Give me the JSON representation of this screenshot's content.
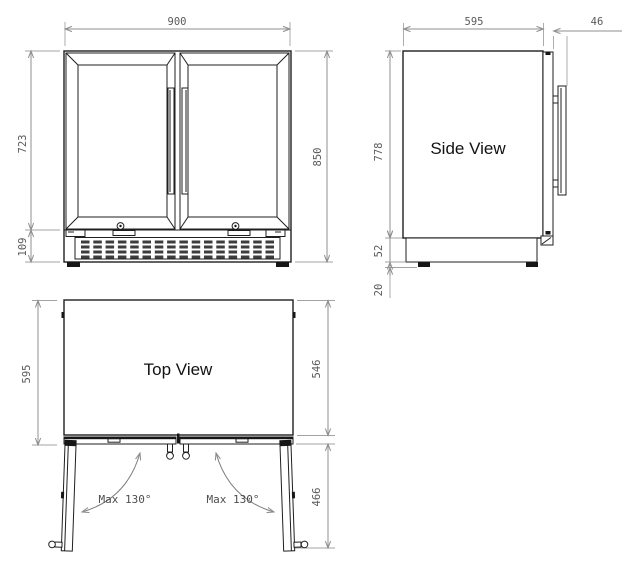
{
  "drawing": {
    "front_view": {
      "width_label": "900",
      "door_height_label": "723",
      "base_height_label": "109",
      "total_height_label": "850"
    },
    "side_view": {
      "title": "Side View",
      "depth_label": "595",
      "door_thickness_label": "46",
      "body_height_label": "778",
      "plinth_height_label": "52",
      "foot_height_label": "20"
    },
    "top_view": {
      "title": "Top View",
      "depth_label": "595",
      "body_depth_label": "546",
      "open_door_label": "466",
      "left_swing_label": "Max 130°",
      "right_swing_label": "Max 130°"
    },
    "colors": {
      "line": "#1f1f1f",
      "dimension": "#8f8f8f",
      "dim_text": "#5a5a5a"
    }
  }
}
